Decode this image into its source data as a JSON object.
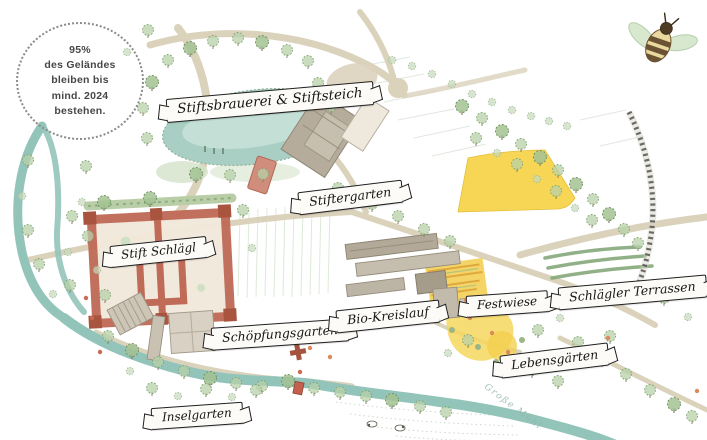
{
  "badge": {
    "lines": [
      "95%",
      "des Geländes",
      "bleiben bis",
      "mind. 2024",
      "bestehen."
    ]
  },
  "labels": [
    {
      "id": "stiftsbrauerei-stiftsteich",
      "text": "Stiftsbrauerei & Stiftsteich"
    },
    {
      "id": "stiftergarten",
      "text": "Stiftergarten"
    },
    {
      "id": "stift-schlaegl",
      "text": "Stift Schlägl"
    },
    {
      "id": "schoepfungsgarten",
      "text": "Schöpfungsgarten"
    },
    {
      "id": "bio-kreislauf",
      "text": "Bio-Kreislauf"
    },
    {
      "id": "festwiese",
      "text": "Festwiese"
    },
    {
      "id": "schlaegler-terrassen",
      "text": "Schlägler Terrassen"
    },
    {
      "id": "lebensgaerten",
      "text": "Lebensgärten"
    },
    {
      "id": "inselgarten",
      "text": "Inselgarten"
    }
  ],
  "river_label": "Große Mühl",
  "icons": {
    "bee": "bee-icon"
  },
  "colors": {
    "water": "#93c4ba",
    "path_beige": "#dbd2bc",
    "monastery_red": "#c06b58",
    "building_grey": "#b5ac9b",
    "meadow_yellow": "#f7d44d",
    "tree_green": "#b7d0a8",
    "railway_dark": "#55544c",
    "banner_ink": "#1f1f1f"
  }
}
